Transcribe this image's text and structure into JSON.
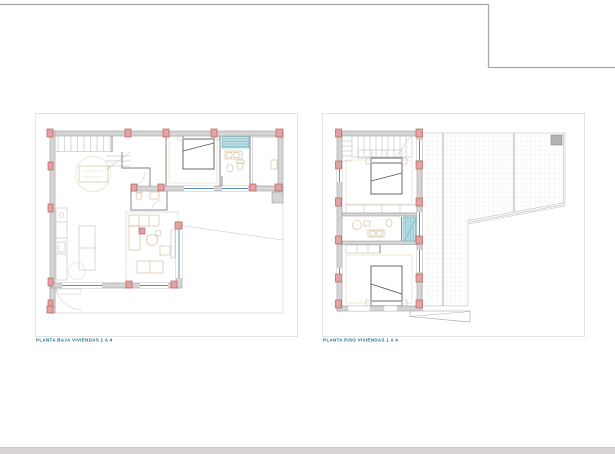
{
  "sheet": {
    "background": "#ffffff",
    "border_color": "#a9a9a9",
    "bottom_band_color": "#d9d2d4"
  },
  "plans": {
    "ground": {
      "label": "PLANTA BAJA VIVIENDAS 1 A 4"
    },
    "upper": {
      "label": "PLANTA PISO VIVIENDAS 1 A 4"
    }
  },
  "colors": {
    "frame_stroke": "#dcdcdc",
    "wall_fill": "#d5d5d5",
    "wall_stroke": "#8f8f8f",
    "column_fill": "#e2a3a3",
    "column_stroke": "#b24d4f",
    "window_blue": "#5d8fb5",
    "shower_teal_fill": "#bfe0e4",
    "shower_teal_stroke": "#5fadb9",
    "furniture_beige": "#cdbb92",
    "bed_dark": "#5a5a5a",
    "thin_line": "#c2c2c2",
    "terrace_joint": "#9a9a9a",
    "grid_line": "#e3e3e3",
    "chimney_fill": "#b4b4b4",
    "label_color": "#1e6b8d",
    "sheet_border": "#a9a9a9",
    "bottom_band": "#d9d2d4"
  }
}
